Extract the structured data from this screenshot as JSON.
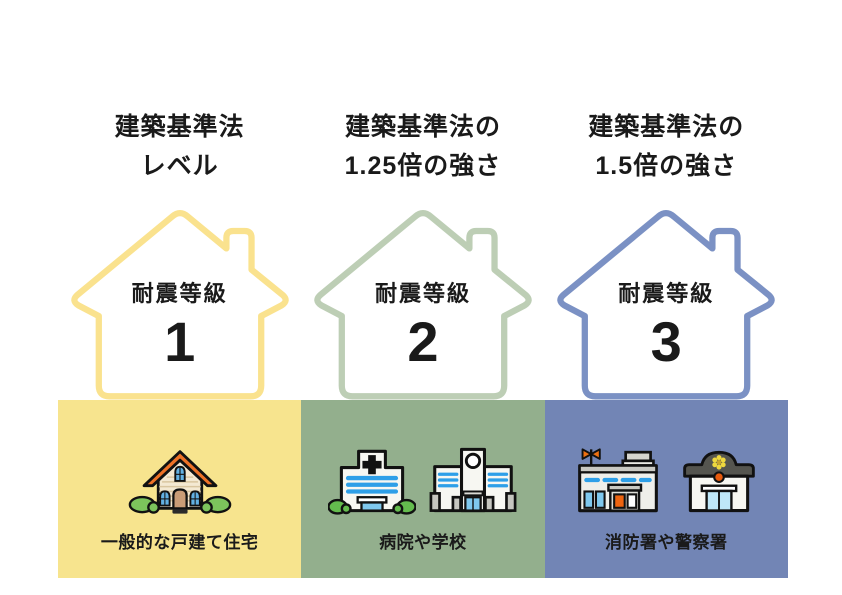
{
  "text_color": "#1a1a1a",
  "columns": [
    {
      "header": {
        "line1": "建築基準法",
        "line2": "レベル"
      },
      "grade": {
        "label": "耐震等級",
        "number": "1"
      },
      "caption": "一般的な戸建て住宅",
      "icons": [
        "detached-house-icon"
      ],
      "colors": {
        "house_outline": "#FAE28E",
        "panel": "#F7E48E"
      }
    },
    {
      "header": {
        "line1": "建築基準法の",
        "line2": "1.25倍の強さ"
      },
      "grade": {
        "label": "耐震等級",
        "number": "2"
      },
      "caption": "病院や学校",
      "icons": [
        "hospital-icon",
        "school-icon"
      ],
      "colors": {
        "house_outline": "#BDCEB5",
        "panel": "#93AF8D"
      }
    },
    {
      "header": {
        "line1": "建築基準法の",
        "line2": "1.5倍の強さ"
      },
      "grade": {
        "label": "耐震等級",
        "number": "3"
      },
      "caption": "消防署や警察署",
      "icons": [
        "fire-station-icon",
        "police-station-icon"
      ],
      "colors": {
        "house_outline": "#7B91C4",
        "panel": "#7285B5"
      }
    }
  ]
}
